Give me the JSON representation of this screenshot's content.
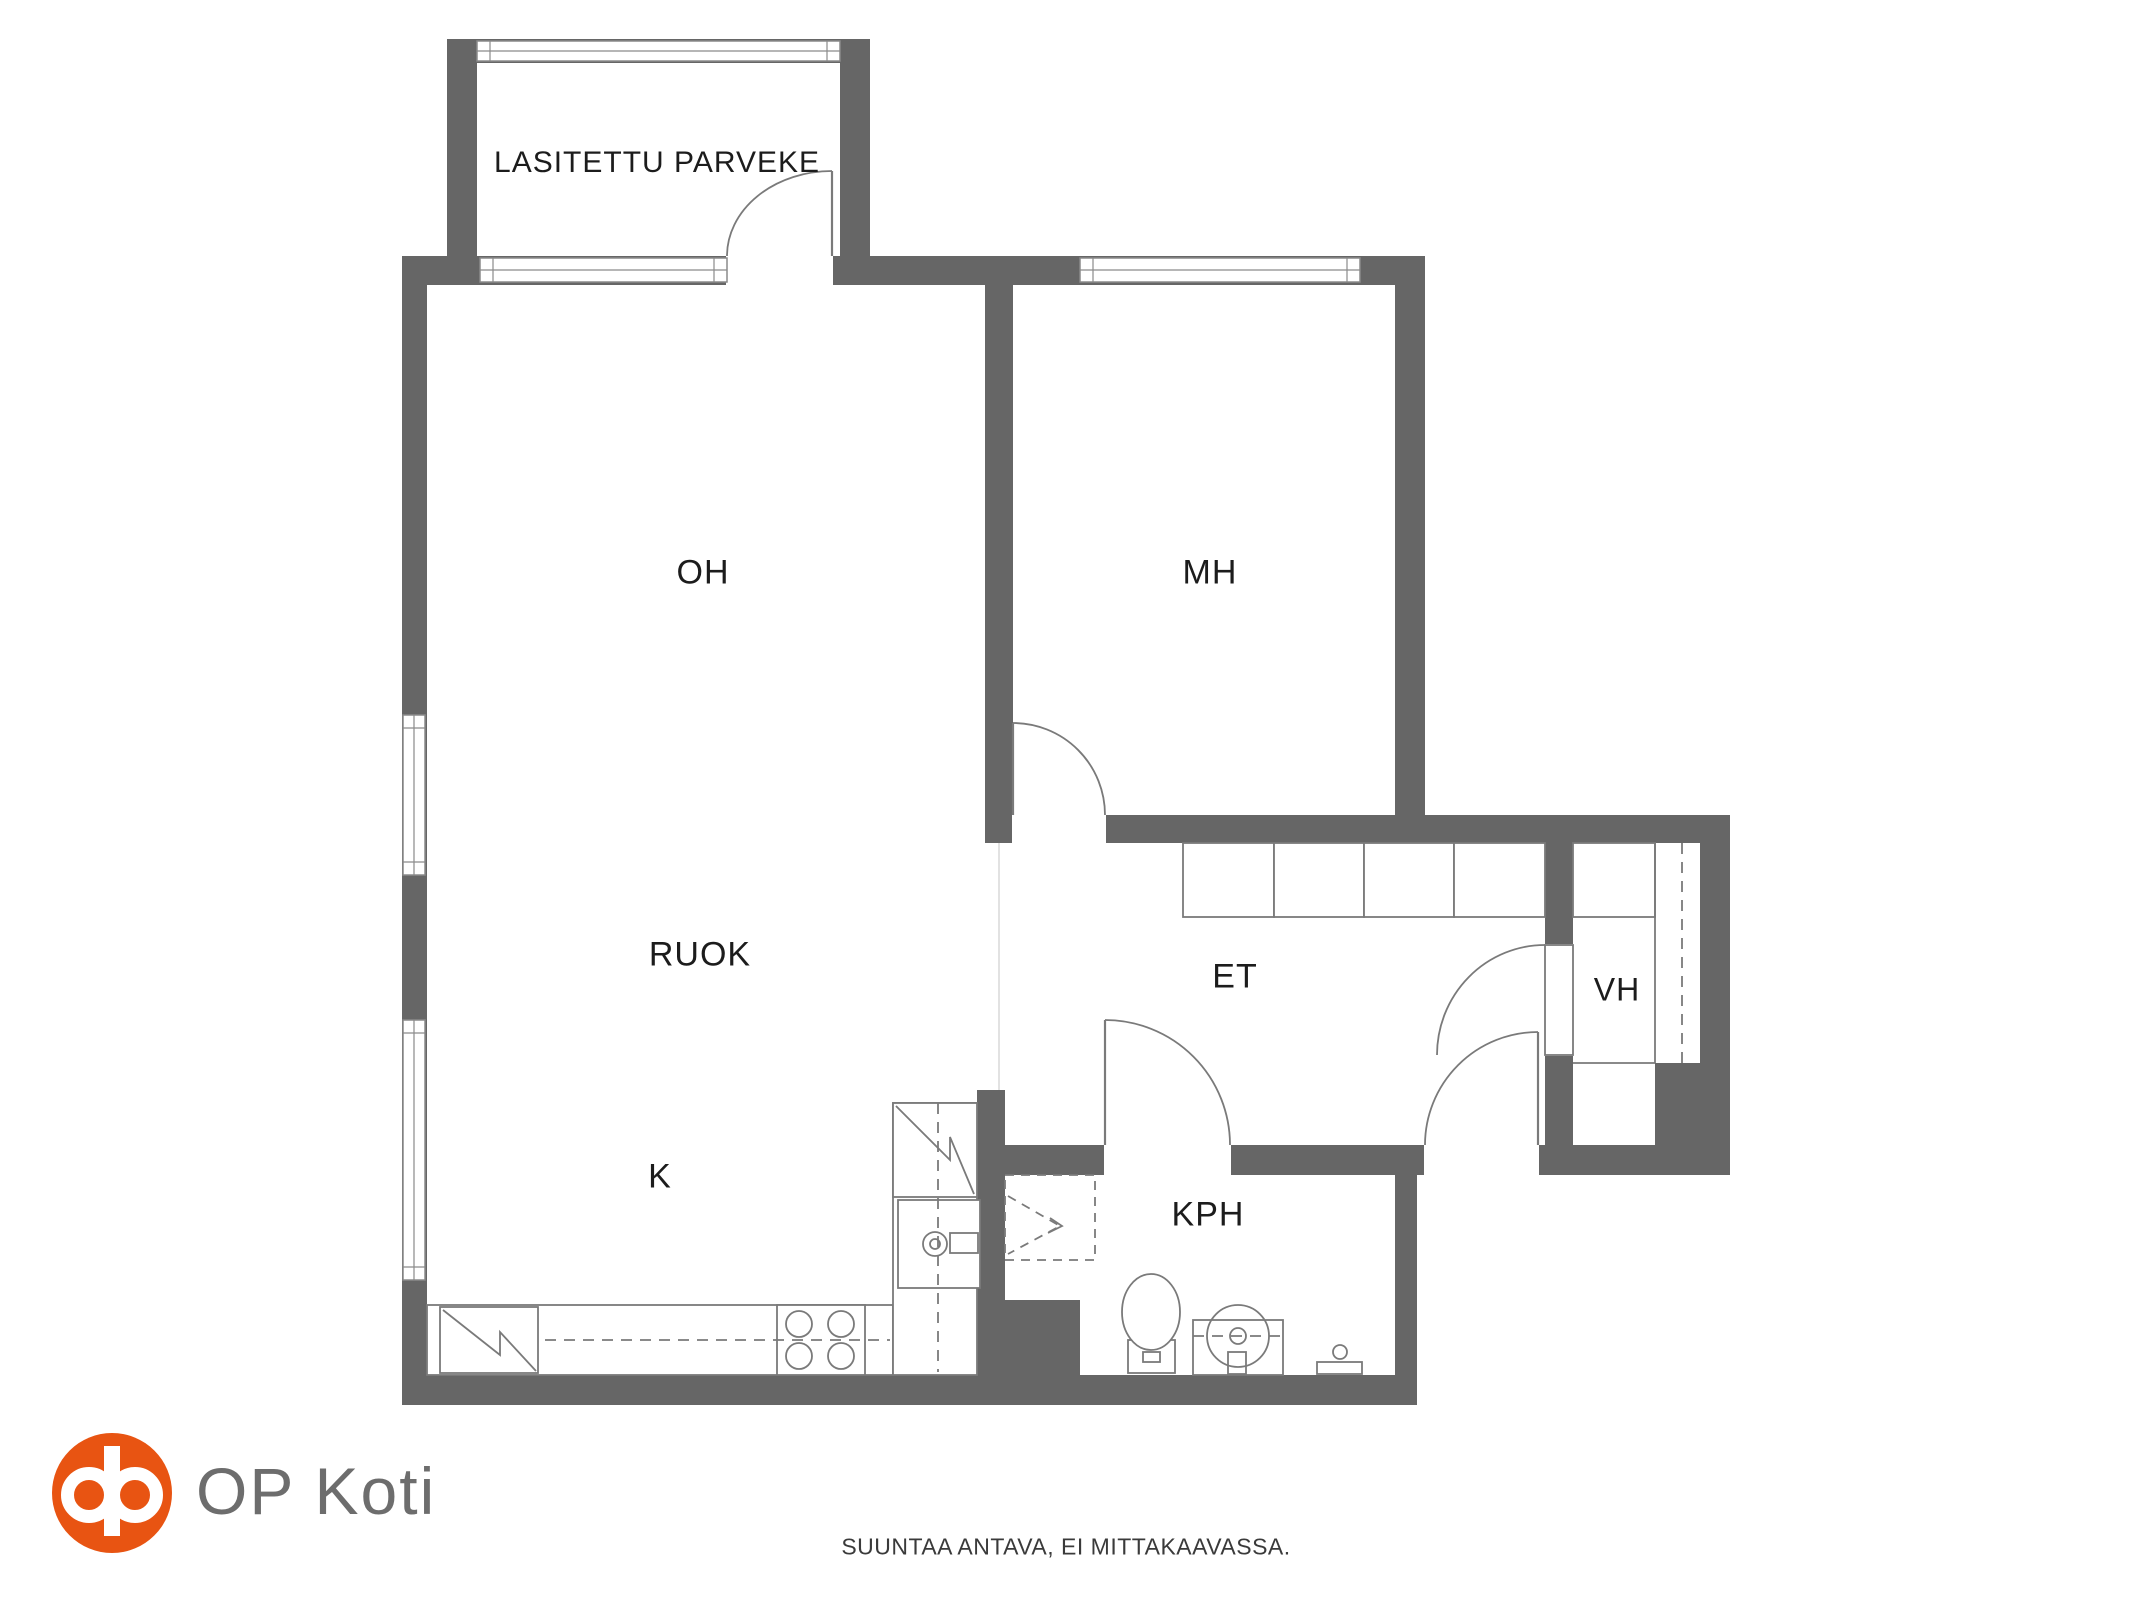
{
  "canvas": {
    "w": 2133,
    "h": 1600
  },
  "colors": {
    "background": "#ffffff",
    "wall": "#666666",
    "furniture_line": "#7a7a7a",
    "window_line": "#8a8a8a",
    "faint_line": "#d9d9d9",
    "label_text": "#1c1c1c",
    "logo_orange": "#e85412",
    "brand_text": "#6d6d6d",
    "disclaimer_text": "#3a3a3a"
  },
  "rooms": [
    {
      "id": "balcony",
      "label": "LASITETTU PARVEKE",
      "cx": 657,
      "cy": 163,
      "font": 30
    },
    {
      "id": "living-room",
      "label": "OH",
      "cx": 703,
      "cy": 573,
      "font": 34
    },
    {
      "id": "bedroom",
      "label": "MH",
      "cx": 1210,
      "cy": 573,
      "font": 34
    },
    {
      "id": "dining",
      "label": "RUOK",
      "cx": 700,
      "cy": 955,
      "font": 34
    },
    {
      "id": "kitchen",
      "label": "K",
      "cx": 660,
      "cy": 1177,
      "font": 34
    },
    {
      "id": "entry-hall",
      "label": "ET",
      "cx": 1235,
      "cy": 977,
      "font": 34
    },
    {
      "id": "closet",
      "label": "VH",
      "cx": 1617,
      "cy": 990,
      "font": 32
    },
    {
      "id": "bathroom",
      "label": "KPH",
      "cx": 1208,
      "cy": 1215,
      "font": 34
    }
  ],
  "walls": [
    {
      "name": "balcony-left-wall",
      "x": 447,
      "y": 39,
      "w": 30,
      "h": 217
    },
    {
      "name": "balcony-right-wall",
      "x": 840,
      "y": 39,
      "w": 30,
      "h": 217
    },
    {
      "name": "balcony-top-wall",
      "x": 447,
      "y": 39,
      "w": 423,
      "h": 24
    },
    {
      "name": "top-wall",
      "x": 402,
      "y": 256,
      "w": 1023,
      "h": 29
    },
    {
      "name": "left-wall",
      "x": 402,
      "y": 256,
      "w": 25,
      "h": 1149
    },
    {
      "name": "bottom-wall",
      "x": 402,
      "y": 1375,
      "w": 1015,
      "h": 30
    },
    {
      "name": "oh-mh-wall",
      "x": 985,
      "y": 285,
      "w": 28,
      "h": 530
    },
    {
      "name": "mh-bottom-wall",
      "x": 985,
      "y": 815,
      "w": 440,
      "h": 28
    },
    {
      "name": "mh-right-wall",
      "x": 1395,
      "y": 285,
      "w": 30,
      "h": 530
    },
    {
      "name": "vh-top-wall",
      "x": 1395,
      "y": 815,
      "w": 335,
      "h": 28
    },
    {
      "name": "right-wall",
      "x": 1700,
      "y": 843,
      "w": 30,
      "h": 220
    },
    {
      "name": "corner-block",
      "x": 1655,
      "y": 1063,
      "w": 75,
      "h": 112
    },
    {
      "name": "et-bottom-wall",
      "x": 977,
      "y": 1145,
      "w": 678,
      "h": 30
    },
    {
      "name": "et-vh-wall",
      "x": 1545,
      "y": 843,
      "w": 28,
      "h": 302
    },
    {
      "name": "kph-left-wall",
      "x": 977,
      "y": 1090,
      "w": 28,
      "h": 285
    },
    {
      "name": "kph-left-block",
      "x": 977,
      "y": 1300,
      "w": 103,
      "h": 75
    },
    {
      "name": "kph-right-wall",
      "x": 1395,
      "y": 1163,
      "w": 22,
      "h": 242
    }
  ],
  "openings": [
    {
      "name": "balcony-door-opening",
      "x": 727,
      "y": 256,
      "w": 105,
      "h": 29
    },
    {
      "name": "mh-door-opening",
      "x": 1013,
      "y": 815,
      "w": 92,
      "h": 28
    },
    {
      "name": "kph-door-opening",
      "x": 1105,
      "y": 1145,
      "w": 125,
      "h": 30
    },
    {
      "name": "entry-door-opening",
      "x": 1425,
      "y": 1145,
      "w": 113,
      "h": 30
    },
    {
      "name": "vh-door-opening",
      "x": 1545,
      "y": 945,
      "w": 28,
      "h": 110
    }
  ],
  "windows": [
    {
      "name": "balcony-window",
      "x": 477,
      "y": 41,
      "w": 363,
      "h": 20,
      "o": "h"
    },
    {
      "name": "oh-top-window",
      "x": 480,
      "y": 258,
      "w": 247,
      "h": 24,
      "o": "h"
    },
    {
      "name": "mh-window",
      "x": 1080,
      "y": 258,
      "w": 280,
      "h": 24,
      "o": "h"
    },
    {
      "name": "left-window-upper",
      "x": 403,
      "y": 715,
      "w": 22,
      "h": 160,
      "o": "v"
    },
    {
      "name": "left-window-lower",
      "x": 403,
      "y": 1020,
      "w": 22,
      "h": 260,
      "o": "v"
    }
  ],
  "doors": [
    {
      "name": "balcony-door",
      "leaf": [
        832,
        171,
        832,
        256
      ],
      "arc": "M727,256 A105,85 0 0 1 832,171"
    },
    {
      "name": "mh-door",
      "leaf": [
        1013,
        723,
        1013,
        815
      ],
      "arc": "M1105,815 A92,92 0 0 0 1013,723"
    },
    {
      "name": "kph-door",
      "leaf": [
        1105,
        1020,
        1105,
        1145
      ],
      "arc": "M1105,1020 A125,125 0 0 1 1230,1145"
    },
    {
      "name": "entry-door",
      "leaf": [
        1538,
        1032,
        1538,
        1145
      ],
      "arc": "M1425,1145 A113,113 0 0 1 1538,1032"
    },
    {
      "name": "vh-door",
      "leaf_rect": [
        1545,
        945,
        28,
        110
      ],
      "arc": "M1437,1055 A108,110 0 0 1 1545,945"
    }
  ],
  "furniture": {
    "rects": [
      {
        "name": "et-closet-cell",
        "x": 1183,
        "y": 843,
        "w": 91,
        "h": 74
      },
      {
        "name": "et-closet-cell",
        "x": 1274,
        "y": 843,
        "w": 90,
        "h": 74
      },
      {
        "name": "et-closet-cell",
        "x": 1364,
        "y": 843,
        "w": 90,
        "h": 74
      },
      {
        "name": "et-closet-cell",
        "x": 1454,
        "y": 843,
        "w": 91,
        "h": 74
      },
      {
        "name": "vh-cabinet",
        "x": 1573,
        "y": 843,
        "w": 82,
        "h": 74
      },
      {
        "name": "kitchen-counter",
        "x": 427,
        "y": 1305,
        "w": 466,
        "h": 70
      },
      {
        "name": "fridge",
        "x": 440,
        "y": 1307,
        "w": 98,
        "h": 66
      },
      {
        "name": "stove",
        "x": 777,
        "y": 1305,
        "w": 88,
        "h": 70
      },
      {
        "name": "kitchen-column",
        "x": 893,
        "y": 1103,
        "w": 84,
        "h": 272
      },
      {
        "name": "tall-cabinet",
        "x": 893,
        "y": 1103,
        "w": 84,
        "h": 94
      },
      {
        "name": "sink-unit",
        "x": 898,
        "y": 1200,
        "w": 82,
        "h": 88
      },
      {
        "name": "sink-handle",
        "x": 950,
        "y": 1233,
        "w": 28,
        "h": 20
      },
      {
        "name": "toilet-base",
        "x": 1128,
        "y": 1340,
        "w": 47,
        "h": 33
      },
      {
        "name": "toilet-button",
        "x": 1143,
        "y": 1352,
        "w": 17,
        "h": 10
      },
      {
        "name": "washbasin-box",
        "x": 1193,
        "y": 1320,
        "w": 90,
        "h": 55
      },
      {
        "name": "washbasin-stub",
        "x": 1228,
        "y": 1352,
        "w": 18,
        "h": 22
      },
      {
        "name": "mixer-bar",
        "x": 1317,
        "y": 1362,
        "w": 45,
        "h": 12
      }
    ],
    "lines": [
      {
        "name": "vh-divider-line",
        "p": [
          1655,
          843,
          1655,
          1063
        ]
      },
      {
        "name": "vh-floor-line",
        "p": [
          1573,
          1063,
          1655,
          1063
        ]
      }
    ],
    "dashed_lines": [
      {
        "name": "vh-rail-dashed",
        "p": [
          1682,
          843,
          1682,
          1063
        ]
      },
      {
        "name": "counter-dashed",
        "p": [
          545,
          1340,
          890,
          1340
        ]
      },
      {
        "name": "column-dashed",
        "p": [
          938,
          1103,
          938,
          1372
        ]
      },
      {
        "name": "washbasin-dashed",
        "p": [
          1193,
          1336,
          1283,
          1336
        ]
      }
    ],
    "faint_lines": [
      {
        "name": "passage-edge",
        "p": [
          999,
          843,
          999,
          1090
        ]
      }
    ],
    "circles": [
      {
        "name": "stove-burner",
        "cx": 799,
        "cy": 1324,
        "r": 13
      },
      {
        "name": "stove-burner",
        "cx": 841,
        "cy": 1324,
        "r": 13
      },
      {
        "name": "stove-burner",
        "cx": 799,
        "cy": 1356,
        "r": 13
      },
      {
        "name": "stove-burner",
        "cx": 841,
        "cy": 1356,
        "r": 13
      },
      {
        "name": "sink-faucet",
        "cx": 935,
        "cy": 1244,
        "r": 12
      },
      {
        "name": "sink-faucet-dot",
        "cx": 935,
        "cy": 1244,
        "r": 5
      },
      {
        "name": "washbasin-bowl",
        "cx": 1238,
        "cy": 1336,
        "r": 31
      },
      {
        "name": "washbasin-drain",
        "cx": 1238,
        "cy": 1336,
        "r": 8
      },
      {
        "name": "mixer-knob",
        "cx": 1340,
        "cy": 1352,
        "r": 7
      }
    ],
    "ellipses": [
      {
        "name": "toilet-bowl",
        "cx": 1151,
        "cy": 1312,
        "rx": 29,
        "ry": 38
      }
    ],
    "paths": [
      {
        "name": "fridge-symbol",
        "d": "M443,1310 L500,1355 L500,1332 L536,1371"
      },
      {
        "name": "tall-cabinet-symbol",
        "d": "M896,1106 L950,1160 L950,1137 L974,1194"
      },
      {
        "name": "shower-arrowhead",
        "d": "M1050,1218 L1062,1226 L1048,1233"
      }
    ],
    "dashed_paths": [
      {
        "name": "shower-area",
        "d": "M1005,1175 H1095 V1260 H1005 Z"
      },
      {
        "name": "shower-arrow",
        "d": "M1008,1196 L1060,1226 L1008,1254"
      }
    ]
  },
  "footer": {
    "brand": "OP Koti",
    "disclaimer": "SUUNTAA ANTAVA, EI MITTAKAAVASSA."
  }
}
